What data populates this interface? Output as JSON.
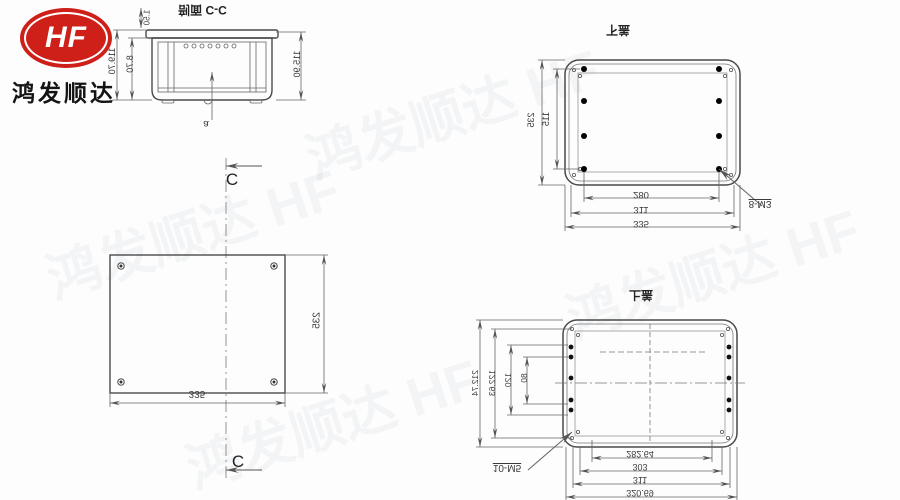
{
  "logo": {
    "monogram": "HF",
    "company": "鸿发顺达",
    "accent": "#ce2018"
  },
  "watermark": {
    "text": "鸿发顺达 HF"
  },
  "section_view": {
    "title": "剖面 C-C",
    "dim_right_height": "115.90",
    "dim_left_outer": "119.70",
    "dim_left_inner": "8.70",
    "dim_top_lip": "1.50",
    "leader_label": "a"
  },
  "plan_view": {
    "section_marker": "C",
    "dim_width": "335",
    "dim_height": "235"
  },
  "bottom_cover_view": {
    "title": "下盖",
    "dim_outer_height": "235",
    "dim_boss_height": "115",
    "dim_boss_width": "280",
    "dim_screw_width": "311",
    "dim_outer_width": "335",
    "hole_label": "8-M3"
  },
  "top_cover_view": {
    "title": "上盖",
    "left_dims": [
      "212.74",
      "122.63",
      "120",
      "80"
    ],
    "bottom_dims": [
      "282.64",
      "303",
      "311",
      "320.69"
    ],
    "hole_label": "10-M5"
  }
}
